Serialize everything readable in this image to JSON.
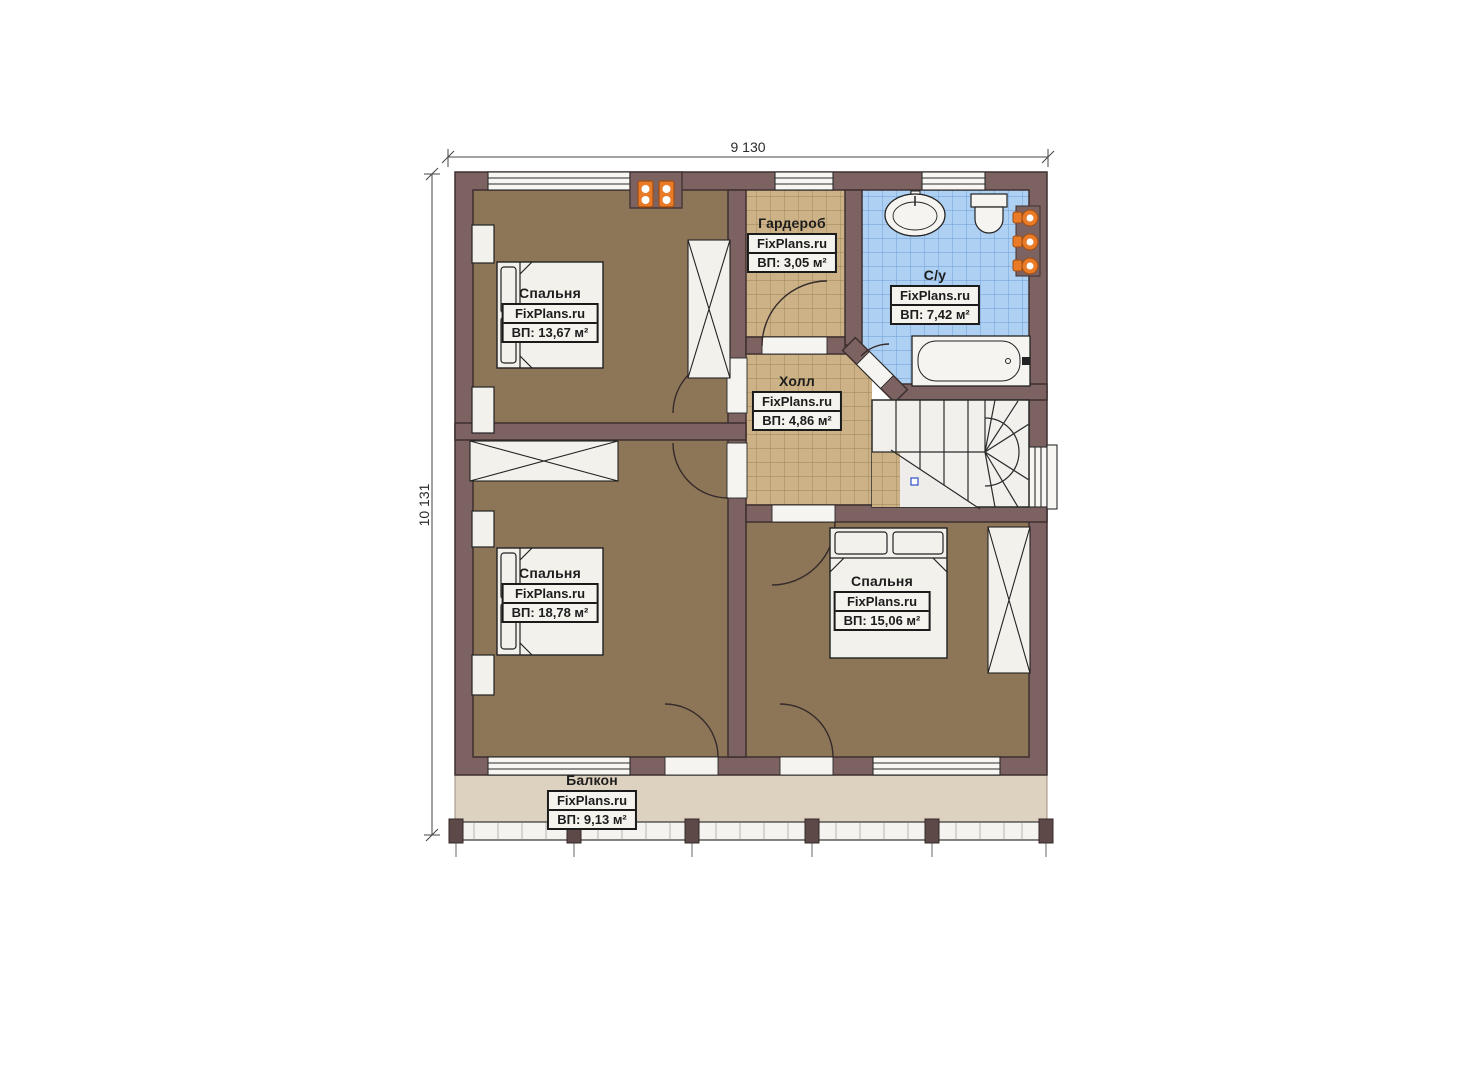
{
  "brand": "FixPlans.ru",
  "dimensions": {
    "width": "9 130",
    "height": "10 131"
  },
  "rooms": {
    "bedroom1": {
      "name": "Спальня",
      "area": "ВП: 13,67 м²"
    },
    "wardrobe": {
      "name": "Гардероб",
      "area": "ВП: 3,05 м²"
    },
    "bathroom": {
      "name": "С/у",
      "area": "ВП: 7,42 м²"
    },
    "hall": {
      "name": "Холл",
      "area": "ВП: 4,86 м²"
    },
    "bedroom2": {
      "name": "Спальня",
      "area": "ВП: 18,78 м²"
    },
    "bedroom3": {
      "name": "Спальня",
      "area": "ВП: 15,06 м²"
    },
    "balcony": {
      "name": "Балкон",
      "area": "ВП: 9,13 м²"
    }
  },
  "colors": {
    "wall": "#7d6262",
    "bedroom_floor": "#8d7557",
    "hall_tile": "#cdb287",
    "bath_tile": "#aed0f2",
    "balcony_floor": "#ddd2c0",
    "accent_orange": "#e87a28",
    "fixture_white": "#f4f3ef"
  }
}
